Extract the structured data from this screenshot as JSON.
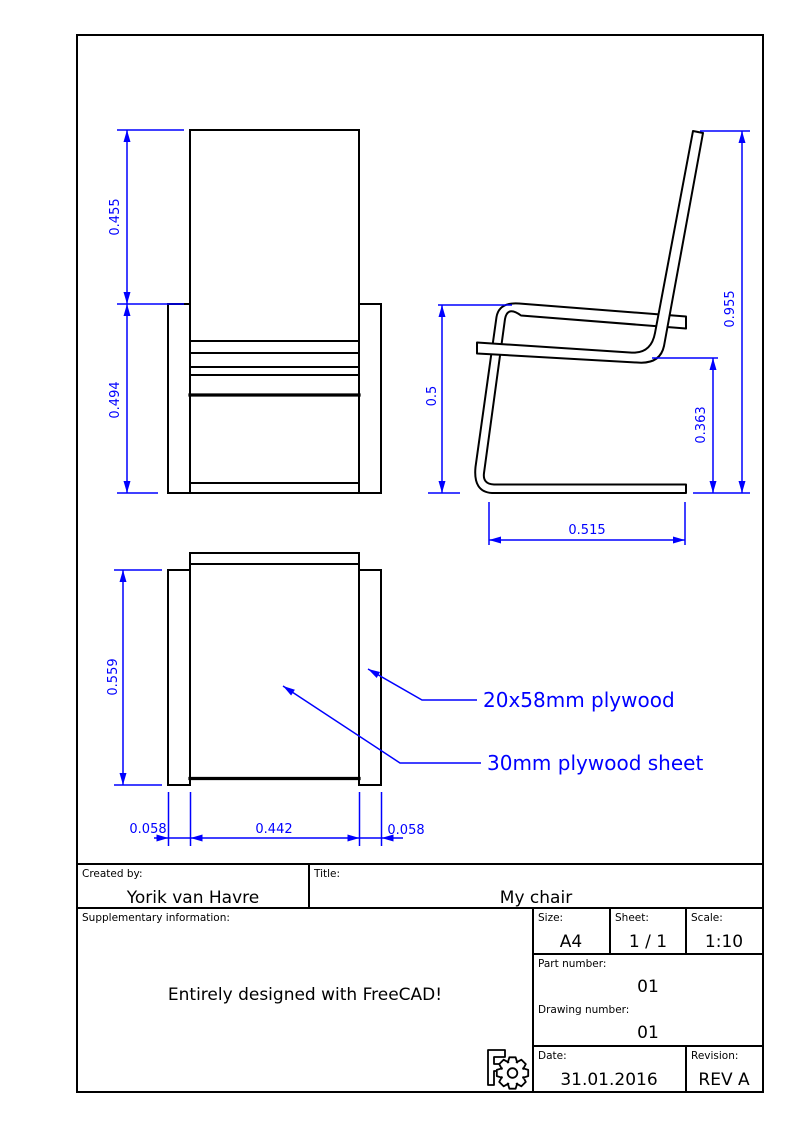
{
  "views": {
    "front": {
      "dims": {
        "backrest_height": "0.455",
        "frame_height": "0.494"
      }
    },
    "side": {
      "dims": {
        "seat_height": "0.5",
        "overall_height": "0.955",
        "under_seat_height": "0.363",
        "base_depth": "0.515"
      }
    },
    "top": {
      "dims": {
        "depth": "0.559",
        "left_strip_width": "0.058",
        "seat_width": "0.442",
        "right_strip_width": "0.058"
      },
      "annotations": {
        "frame_material": "20x58mm plywood",
        "seat_material": "30mm plywood sheet"
      }
    }
  },
  "title_block": {
    "created_by_label": "Created by:",
    "created_by": "Yorik van Havre",
    "title_label": "Title:",
    "title": "My chair",
    "supplementary_label": "Supplementary information:",
    "supplementary": "Entirely designed with FreeCAD!",
    "size_label": "Size:",
    "size": "A4",
    "sheet_label": "Sheet:",
    "sheet": "1 / 1",
    "scale_label": "Scale:",
    "scale": "1:10",
    "part_number_label": "Part number:",
    "part_number": "01",
    "drawing_number_label": "Drawing number:",
    "drawing_number": "01",
    "date_label": "Date:",
    "date": "31.01.2016",
    "revision_label": "Revision:",
    "revision": "REV A"
  },
  "icons": {
    "logo": "freecad-gear-logo"
  },
  "colors": {
    "dimension": "#0000ff",
    "geometry": "#000000"
  }
}
